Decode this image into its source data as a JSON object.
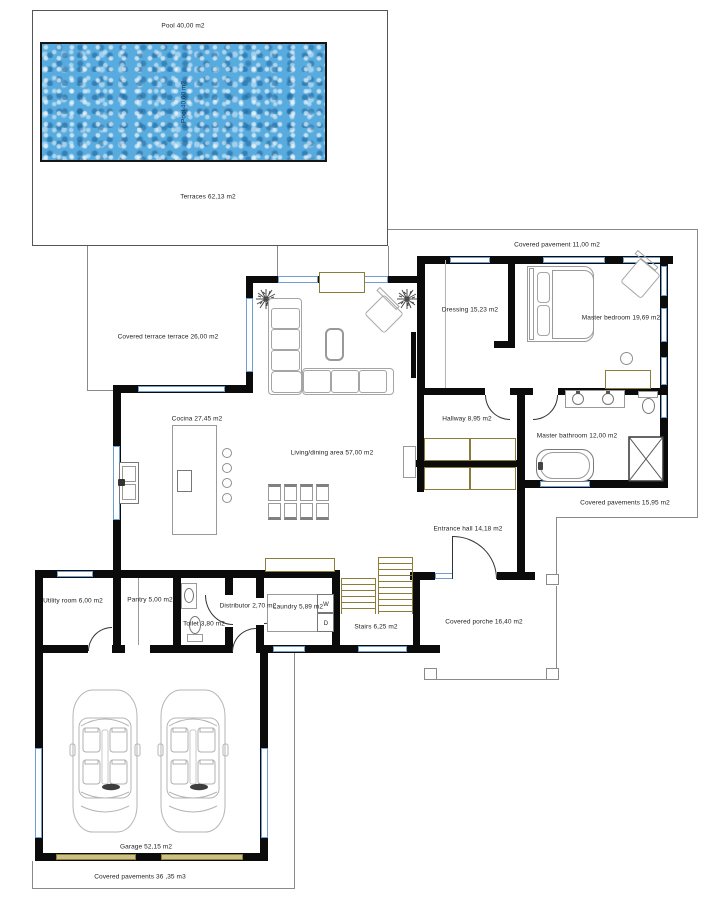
{
  "diagram_type": "architectural-floor-plan",
  "colors": {
    "wall": "#0b0b0b",
    "window": "#6f9fd0",
    "joinery_tan": "#8a7d3a",
    "pool_water": "#58abde",
    "outline": "#8a8a8a",
    "furniture_stroke": "#9a9a9a"
  },
  "labels": {
    "pool_top": "Pool 40,00 m2",
    "pool_inner": "Pool 40,00 m2",
    "terraces": "Terraces 62,13 m2",
    "covered_pavement_top": "Covered pavement 11,00 m2",
    "covered_terrace": "Covered terrace terrace 26,00 m2",
    "dressing": "Dressing 15,23 m2",
    "master_bedroom": "Master bedroom 19,69 m2",
    "cocina": "Cocina 27,45 m2",
    "living_dining": "Living/dining area  57,00 m2",
    "hallway": "Hallway 8,95 m2",
    "master_bathroom": "Master bathroom 12,00 m2",
    "covered_pavements_east": "Covered pavements 15,95 m2",
    "entrance_hall": "Entrance hall 14,18 m2",
    "utility_room": "Utility room 6,00 m2",
    "pantry": "Pantry 5,00 m2",
    "distributor": "Distributor 2,70 m2",
    "laundry": "Laundry 5,89 m2",
    "toilet": "Toilet 3,80 m2",
    "stairs": "Stairs 6,25 m2",
    "covered_porche": "Covered porche 16,40 m2",
    "garage": "Garage 52,15 m2",
    "covered_pavements_bottom": "Covered pavements 36 ,35 m3",
    "washer": "W",
    "dryer": "D"
  }
}
